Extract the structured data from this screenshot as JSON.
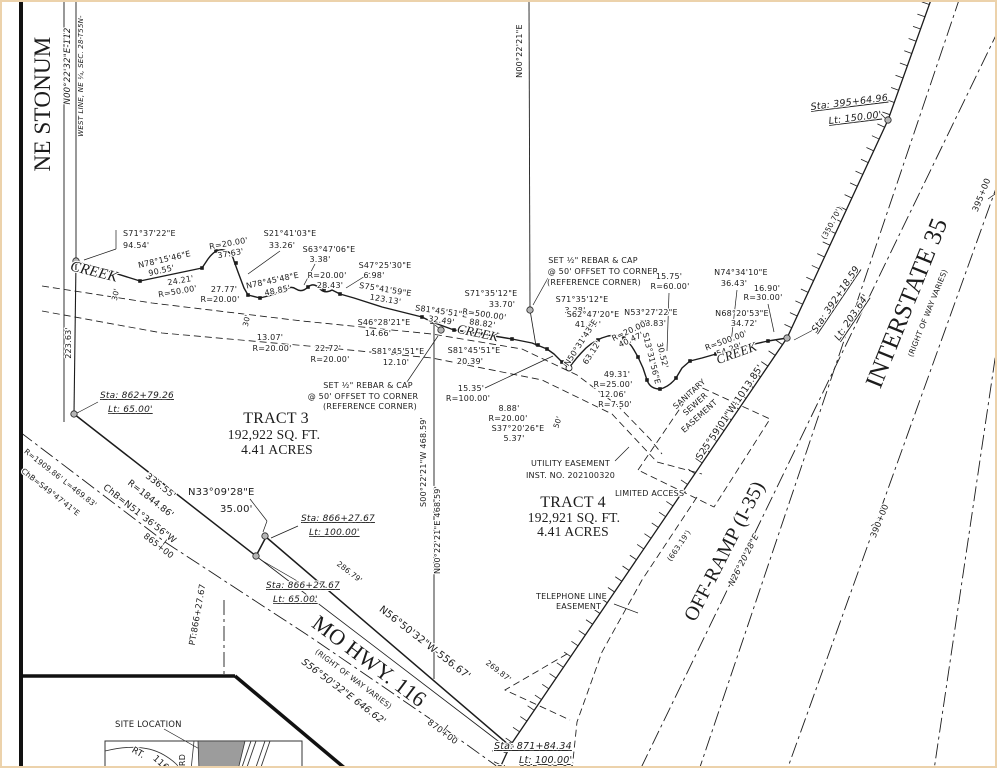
{
  "page": {
    "background": "#ffffff",
    "border_tint": "#ecd2ab",
    "ink": "#1c1c1c",
    "monument_gray": "#b5b5b5",
    "parcel_gray": "#9c9c9c"
  },
  "plat": {
    "tract3": {
      "name": "TRACT 3",
      "area": "192,922 SQ. FT.",
      "acres": "4.41 ACRES"
    },
    "tract4": {
      "name": "TRACT 4",
      "area": "192,921 SQ. FT.",
      "acres": "4.41 ACRES"
    },
    "roads": [
      "NE STONUM",
      "MO HWY. 116",
      "OFF-RAMP (I-35)",
      "INTERSTATE 35"
    ],
    "easements": [
      "SANITARY SEWER EASEMENT",
      "UTILITY EASEMENT INST. NO. 202100320",
      "TELEPHONE LINE EASEMENT",
      "LIMITED ACCESS"
    ]
  },
  "labels": [
    {
      "t": "NE STONUM",
      "x": 48,
      "y": 102,
      "r": -90,
      "s": 23,
      "f": "serif"
    },
    {
      "t": "N00°22'32\"E-112",
      "x": 68,
      "y": 64,
      "r": -90,
      "s": 8.5,
      "i": 1
    },
    {
      "t": "WEST LINE, NE ¼, SEC. 28-T55N-",
      "x": 81,
      "y": 74,
      "r": -90,
      "s": 7,
      "i": 1
    },
    {
      "t": "223.63'",
      "x": 69,
      "y": 341,
      "r": -90,
      "s": 8
    },
    {
      "t": "S71°37'22\"E",
      "x": 121,
      "y": 234,
      "a": "s"
    },
    {
      "t": "94.54'",
      "x": 121,
      "y": 246,
      "a": "s"
    },
    {
      "t": "CREEK",
      "x": 91,
      "y": 274,
      "r": 14,
      "s": 15,
      "f": "serif",
      "i": 1
    },
    {
      "t": "N78°15'46\"E",
      "x": 163,
      "y": 260,
      "r": -13
    },
    {
      "t": "90.55'",
      "x": 160,
      "y": 271,
      "r": -13
    },
    {
      "t": "24.21'",
      "x": 179,
      "y": 281,
      "r": -10
    },
    {
      "t": "R=50.00'",
      "x": 176,
      "y": 292,
      "r": -10
    },
    {
      "t": "R=20.00'",
      "x": 227,
      "y": 244,
      "r": -10
    },
    {
      "t": "37.63'",
      "x": 229,
      "y": 254,
      "r": -10
    },
    {
      "t": "S21°41'03\"E",
      "x": 288,
      "y": 234
    },
    {
      "t": "33.26'",
      "x": 280,
      "y": 246
    },
    {
      "t": "27.77'",
      "x": 222,
      "y": 290
    },
    {
      "t": "R=20.00'",
      "x": 218,
      "y": 300
    },
    {
      "t": "N78°45'48\"E",
      "x": 271,
      "y": 281,
      "r": -12
    },
    {
      "t": "48.85'",
      "x": 276,
      "y": 291,
      "r": -12
    },
    {
      "t": "13.07'",
      "x": 268,
      "y": 338
    },
    {
      "t": "R=20.00'",
      "x": 270,
      "y": 349
    },
    {
      "t": "S63°47'06\"E",
      "x": 327,
      "y": 250
    },
    {
      "t": "3.38'",
      "x": 318,
      "y": 260
    },
    {
      "t": "R=20.00'",
      "x": 325,
      "y": 276
    },
    {
      "t": "28.43'",
      "x": 328,
      "y": 286
    },
    {
      "t": "S47°25'30\"E",
      "x": 383,
      "y": 266
    },
    {
      "t": "6.98'",
      "x": 372,
      "y": 276
    },
    {
      "t": "S75°41'59\"E",
      "x": 383,
      "y": 290,
      "r": 9
    },
    {
      "t": "123.13'",
      "x": 383,
      "y": 300,
      "r": 9
    },
    {
      "t": "S46°28'21\"E",
      "x": 382,
      "y": 323
    },
    {
      "t": "14.66'",
      "x": 376,
      "y": 334
    },
    {
      "t": "22.72'",
      "x": 326,
      "y": 349
    },
    {
      "t": "R=20.00'",
      "x": 328,
      "y": 360
    },
    {
      "t": "S81°45'51\"E",
      "x": 439,
      "y": 312,
      "r": 8
    },
    {
      "t": "32.49'",
      "x": 439,
      "y": 321,
      "r": 8
    },
    {
      "t": "R=500.00'",
      "x": 482,
      "y": 315,
      "r": 8
    },
    {
      "t": "88.82'",
      "x": 480,
      "y": 324,
      "r": 8
    },
    {
      "t": "S71°35'12\"E",
      "x": 489,
      "y": 294
    },
    {
      "t": "33.70'",
      "x": 500,
      "y": 305
    },
    {
      "t": "S81°45'51\"E",
      "x": 396,
      "y": 352
    },
    {
      "t": "12.10'",
      "x": 394,
      "y": 363
    },
    {
      "t": "S81°45'51\"E",
      "x": 472,
      "y": 351
    },
    {
      "t": "20.39'",
      "x": 468,
      "y": 362
    },
    {
      "t": "CREEK",
      "x": 475,
      "y": 335,
      "r": 12,
      "s": 13,
      "f": "serif",
      "i": 1
    },
    {
      "t": "SET ½\" REBAR & CAP",
      "x": 366,
      "y": 386
    },
    {
      "t": "@ 50' OFFSET TO CORNER",
      "x": 361,
      "y": 397
    },
    {
      "t": "(REFERENCE CORNER)",
      "x": 368,
      "y": 407
    },
    {
      "t": "15.35'",
      "x": 469,
      "y": 389
    },
    {
      "t": "R=100.00'",
      "x": 466,
      "y": 399
    },
    {
      "t": "SET ½\" REBAR & CAP",
      "x": 591,
      "y": 261
    },
    {
      "t": "@ 50' OFFSET TO CORNER",
      "x": 601,
      "y": 272
    },
    {
      "t": "(REFERENCE CORNER)",
      "x": 592,
      "y": 283
    },
    {
      "t": "S71°35'12\"E",
      "x": 580,
      "y": 300
    },
    {
      "t": "3.28'",
      "x": 573,
      "y": 311
    },
    {
      "t": "S62°47'20\"E",
      "x": 591,
      "y": 315
    },
    {
      "t": "41.87'",
      "x": 586,
      "y": 325
    },
    {
      "t": "N53°27'22\"E",
      "x": 649,
      "y": 313
    },
    {
      "t": "28.83'",
      "x": 651,
      "y": 324
    },
    {
      "t": "15.75'",
      "x": 667,
      "y": 277
    },
    {
      "t": "R=60.00'",
      "x": 668,
      "y": 287
    },
    {
      "t": "N74°34'10\"E",
      "x": 739,
      "y": 273
    },
    {
      "t": "36.43'",
      "x": 732,
      "y": 284
    },
    {
      "t": "16.90'",
      "x": 765,
      "y": 289
    },
    {
      "t": "R=30.00'",
      "x": 761,
      "y": 298
    },
    {
      "t": "N68°20'53\"E",
      "x": 740,
      "y": 314
    },
    {
      "t": "34.72'",
      "x": 742,
      "y": 324
    },
    {
      "t": "R=20.00'",
      "x": 629,
      "y": 331,
      "r": -25
    },
    {
      "t": "40.47'",
      "x": 630,
      "y": 340,
      "r": -25
    },
    {
      "t": "N50°31'43\"E",
      "x": 581,
      "y": 342,
      "r": -57
    },
    {
      "t": "63.12'",
      "x": 592,
      "y": 352,
      "r": -57
    },
    {
      "t": "S13°31'56\"E",
      "x": 647,
      "y": 357,
      "r": 76
    },
    {
      "t": "30.52'",
      "x": 658,
      "y": 354,
      "r": 76
    },
    {
      "t": "49.31'",
      "x": 615,
      "y": 375
    },
    {
      "t": "R=25.00'",
      "x": 611,
      "y": 385
    },
    {
      "t": "12.06'",
      "x": 611,
      "y": 395
    },
    {
      "t": "R=7.50'",
      "x": 613,
      "y": 405
    },
    {
      "t": "8.88'",
      "x": 507,
      "y": 409
    },
    {
      "t": "R=20.00'",
      "x": 506,
      "y": 419
    },
    {
      "t": "S37°20'26\"E",
      "x": 516,
      "y": 429
    },
    {
      "t": "5.37'",
      "x": 512,
      "y": 439
    },
    {
      "t": "R=500.00'",
      "x": 725,
      "y": 341,
      "r": -20
    },
    {
      "t": "54.29'",
      "x": 728,
      "y": 350,
      "r": -20
    },
    {
      "t": "CREEK",
      "x": 736,
      "y": 355,
      "r": -20,
      "s": 13,
      "f": "serif",
      "i": 1
    },
    {
      "t": "TRACT 3",
      "x": 274,
      "y": 421,
      "s": 16,
      "f": "serif"
    },
    {
      "t": "192,922 SQ. FT.",
      "x": 272,
      "y": 437,
      "s": 13.5,
      "f": "serif"
    },
    {
      "t": "4.41 ACRES",
      "x": 275,
      "y": 452,
      "s": 13.5,
      "f": "serif"
    },
    {
      "t": "TRACT 4",
      "x": 571,
      "y": 505,
      "s": 16,
      "f": "serif"
    },
    {
      "t": "192,921 SQ. FT.",
      "x": 572,
      "y": 520,
      "s": 13.5,
      "f": "serif"
    },
    {
      "t": "4.41 ACRES",
      "x": 571,
      "y": 534,
      "s": 13.5,
      "f": "serif"
    },
    {
      "t": "S00°22'21\"W 468.59'",
      "x": 424,
      "y": 460,
      "r": -90
    },
    {
      "t": "N00°22'21\"E 468.59'",
      "x": 438,
      "y": 528,
      "r": -90
    },
    {
      "t": "N00°22'21\"E",
      "x": 520,
      "y": 49,
      "r": -90
    },
    {
      "t": "Sta: 862+79.26",
      "x": 98,
      "y": 396,
      "a": "s",
      "s": 9,
      "i": 1,
      "u": 1
    },
    {
      "t": "Lt: 65.00'",
      "x": 106,
      "y": 410,
      "a": "s",
      "s": 9,
      "i": 1,
      "u": 1
    },
    {
      "t": "336.55'",
      "x": 157,
      "y": 486,
      "r": 38,
      "s": 9
    },
    {
      "t": "R=1844.86'",
      "x": 147,
      "y": 499,
      "r": 38,
      "s": 9
    },
    {
      "t": "ChB=N51°36'56\"W",
      "x": 136,
      "y": 514,
      "r": 38,
      "s": 9
    },
    {
      "t": "R=1909.86' L=469.83'",
      "x": 57,
      "y": 478,
      "r": 38,
      "s": 7.5
    },
    {
      "t": "ChB=S49°47'41\"E",
      "x": 47,
      "y": 492,
      "r": 38,
      "s": 7.5
    },
    {
      "t": "865+00",
      "x": 155,
      "y": 546,
      "r": 38,
      "s": 8.5
    },
    {
      "t": "N33°09'28\"E",
      "x": 186,
      "y": 493,
      "a": "s",
      "s": 10
    },
    {
      "t": "35.00'",
      "x": 218,
      "y": 510,
      "a": "s",
      "s": 10
    },
    {
      "t": "Sta: 866+27.67",
      "x": 299,
      "y": 519,
      "a": "s",
      "s": 9,
      "i": 1,
      "u": 1
    },
    {
      "t": "Lt: 100.00'",
      "x": 307,
      "y": 533,
      "a": "s",
      "s": 9,
      "i": 1,
      "u": 1
    },
    {
      "t": "Sta: 866+27.67",
      "x": 264,
      "y": 586,
      "a": "s",
      "s": 9,
      "i": 1,
      "u": 1
    },
    {
      "t": "Lt: 65.00'",
      "x": 271,
      "y": 600,
      "a": "s",
      "s": 9,
      "i": 1,
      "u": 1
    },
    {
      "t": "PT:866+27.67",
      "x": 198,
      "y": 613,
      "r": -80,
      "s": 8.5
    },
    {
      "t": "286.79'",
      "x": 346,
      "y": 572,
      "r": 38,
      "s": 7.5
    },
    {
      "t": "MO HWY. 116",
      "x": 363,
      "y": 665,
      "r": 37,
      "s": 22,
      "f": "serif"
    },
    {
      "t": "(RIGHT OF WAY VARIES)",
      "x": 350,
      "y": 679,
      "r": 37,
      "s": 7.5
    },
    {
      "t": "S56°50'32\"E  646.62'",
      "x": 340,
      "y": 692,
      "r": 37,
      "s": 9.5,
      "i": 1
    },
    {
      "t": "N56°50'32\"W-556.67'",
      "x": 421,
      "y": 643,
      "r": 38,
      "s": 10
    },
    {
      "t": "269.87'",
      "x": 495,
      "y": 671,
      "r": 38,
      "s": 7.5
    },
    {
      "t": "870+00",
      "x": 439,
      "y": 732,
      "r": 37,
      "s": 8.5
    },
    {
      "t": "Sta: 871+84.34",
      "x": 492,
      "y": 747,
      "a": "s",
      "s": 9.5,
      "i": 1,
      "u": 1
    },
    {
      "t": "Lt: 100.00'",
      "x": 517,
      "y": 761,
      "a": "s",
      "s": 9.5,
      "i": 1,
      "u": 1
    },
    {
      "t": "Sta: 385+63.04",
      "x": 494,
      "y": 770,
      "a": "s",
      "s": 9.5,
      "i": 1,
      "u": 1
    },
    {
      "t": "TELEPHONE LINE",
      "x": 534,
      "y": 597,
      "a": "s"
    },
    {
      "t": "EASEMENT",
      "x": 554,
      "y": 607,
      "a": "s"
    },
    {
      "t": "LIMITED ACCESS",
      "x": 613,
      "y": 494,
      "a": "s"
    },
    {
      "t": "UTILITY EASEMENT",
      "x": 529,
      "y": 464,
      "a": "s"
    },
    {
      "t": "INST. NO. 202100320",
      "x": 524,
      "y": 476,
      "a": "s"
    },
    {
      "t": "SANITARY",
      "x": 689,
      "y": 394,
      "r": -42
    },
    {
      "t": "SEWER",
      "x": 695,
      "y": 404,
      "r": -42
    },
    {
      "t": "EASEMENT",
      "x": 699,
      "y": 416,
      "r": -42
    },
    {
      "t": "S25°59'01\"W-1013.85'",
      "x": 730,
      "y": 412,
      "r": -56,
      "s": 9.5
    },
    {
      "t": "(663.19')",
      "x": 679,
      "y": 545,
      "r": -56,
      "s": 7.5
    },
    {
      "t": "OFF-RAMP (I-35)",
      "x": 728,
      "y": 552,
      "r": -63,
      "s": 20,
      "f": "serif"
    },
    {
      "t": "N26°20'28\"E",
      "x": 744,
      "y": 559,
      "r": -63,
      "s": 8.5,
      "i": 1
    },
    {
      "t": "Sta: 392+18.59",
      "x": 836,
      "y": 299,
      "r": -56,
      "s": 9.5,
      "i": 1,
      "u": 1
    },
    {
      "t": "Lt: 203.64'",
      "x": 852,
      "y": 317,
      "r": -56,
      "s": 9.5,
      "i": 1,
      "u": 1
    },
    {
      "t": "(350.70')",
      "x": 832,
      "y": 222,
      "r": -62,
      "s": 7.5
    },
    {
      "t": "Sta: 395+64.96",
      "x": 809,
      "y": 108,
      "a": "s",
      "r": -7,
      "s": 9.5,
      "i": 1,
      "u": 1
    },
    {
      "t": "Lt: 150.00'",
      "x": 827,
      "y": 122,
      "a": "s",
      "r": -7,
      "s": 9.5,
      "i": 1,
      "u": 1
    },
    {
      "t": "INTERSTATE 35",
      "x": 912,
      "y": 304,
      "r": -68,
      "s": 25,
      "f": "serif"
    },
    {
      "t": "(RIGHT OF WAY VARIES)",
      "x": 928,
      "y": 312,
      "r": -68,
      "s": 7.5
    },
    {
      "t": "395+00",
      "x": 982,
      "y": 194,
      "r": -68,
      "s": 8.5
    },
    {
      "t": "390+00",
      "x": 880,
      "y": 520,
      "r": -68,
      "s": 8.5
    },
    {
      "t": "30'",
      "x": 116,
      "y": 293,
      "r": -78,
      "s": 7.5
    },
    {
      "t": "30'",
      "x": 247,
      "y": 319,
      "r": -78,
      "s": 7.5
    },
    {
      "t": "50'",
      "x": 558,
      "y": 421,
      "r": -72,
      "s": 7.5
    },
    {
      "t": "SITE LOCATION",
      "x": 113,
      "y": 725,
      "a": "s",
      "s": 8.5
    },
    {
      "t": "RT.",
      "x": 135,
      "y": 753,
      "r": 30,
      "s": 9
    },
    {
      "t": "116",
      "x": 157,
      "y": 763,
      "r": 42,
      "s": 9
    },
    {
      "t": "RD",
      "x": 183,
      "y": 758,
      "r": -90,
      "s": 8
    }
  ]
}
